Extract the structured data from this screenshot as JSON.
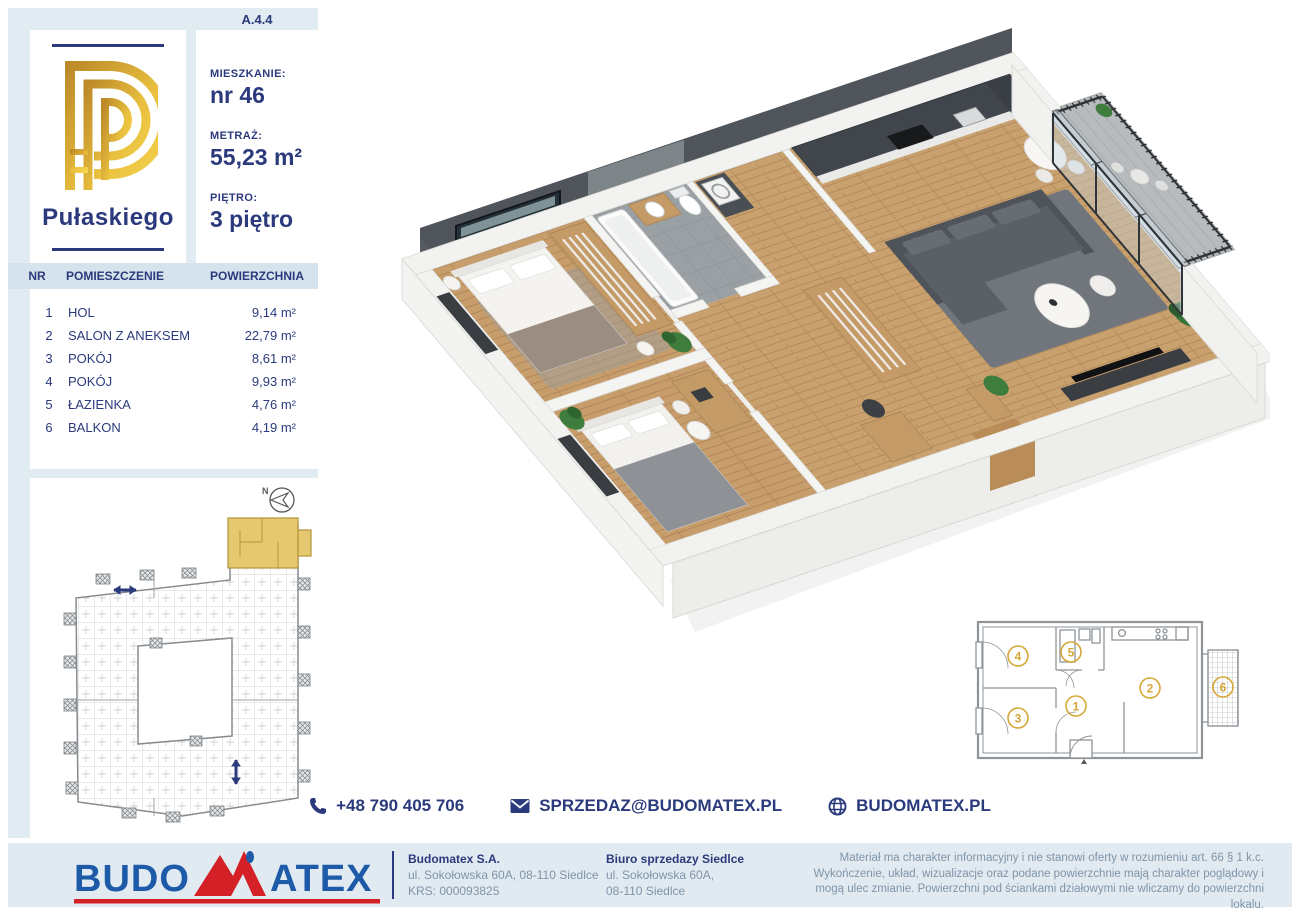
{
  "badge": "A.4.4",
  "project": {
    "name": "Pułaskiego"
  },
  "unit": {
    "apartment_label": "MIESZKANIE:",
    "apartment_value": "nr 46",
    "area_label": "METRAŻ:",
    "area_value": "55,23 m²",
    "floor_label": "PIĘTRO:",
    "floor_value": "3 piętro"
  },
  "rooms_table": {
    "headers": [
      "NR",
      "POMIESZCZENIE",
      "POWIERZCHNIA"
    ],
    "rows": [
      [
        "1",
        "HOL",
        "9,14 m²"
      ],
      [
        "2",
        "SALON Z ANEKSEM",
        "22,79 m²"
      ],
      [
        "3",
        "POKÓJ",
        "8,61 m²"
      ],
      [
        "4",
        "POKÓJ",
        "9,93 m²"
      ],
      [
        "5",
        "ŁAZIENKA",
        "4,76 m²"
      ],
      [
        "6",
        "BALKON",
        "4,19 m²"
      ]
    ]
  },
  "site_plan": {
    "compass_label": "N"
  },
  "schematic": {
    "room_numbers": [
      "1",
      "2",
      "3",
      "4",
      "5",
      "6"
    ]
  },
  "contact": {
    "phone": "+48 790 405 706",
    "email": "SPRZEDAZ@BUDOMATEX.PL",
    "website": "BUDOMATEX.PL"
  },
  "footer": {
    "logo_budo": "BUDO",
    "logo_atex": "ATEX",
    "company_name": "Budomatex S.A.",
    "company_address": "ul. Sokołowska 60A, 08-110 Siedlce",
    "company_krs": "KRS: 000093825",
    "office_name": "Biuro sprzedazy Siedlce",
    "office_address_line1": "ul. Sokołowska 60A,",
    "office_address_line2": "08-110 Siedlce",
    "legal": "Materiał ma charakter informacyjny i nie stanowi oferty w rozumieniu art. 66 § 1 k.c. Wykończenie, układ, wizualizacje oraz podane powierzchnie mają charakter poglądowy i mogą ulec zmianie. Powierzchni pod ściankami działowymi nie wliczamy do powierzchni lokalu."
  },
  "colors": {
    "navy": "#2b3a7d",
    "gold": "#d5a737",
    "gold_fill": "#e6c870",
    "light_blue": "#e1ebf2",
    "logo_blue": "#1d5aa8",
    "logo_red": "#d42027"
  }
}
